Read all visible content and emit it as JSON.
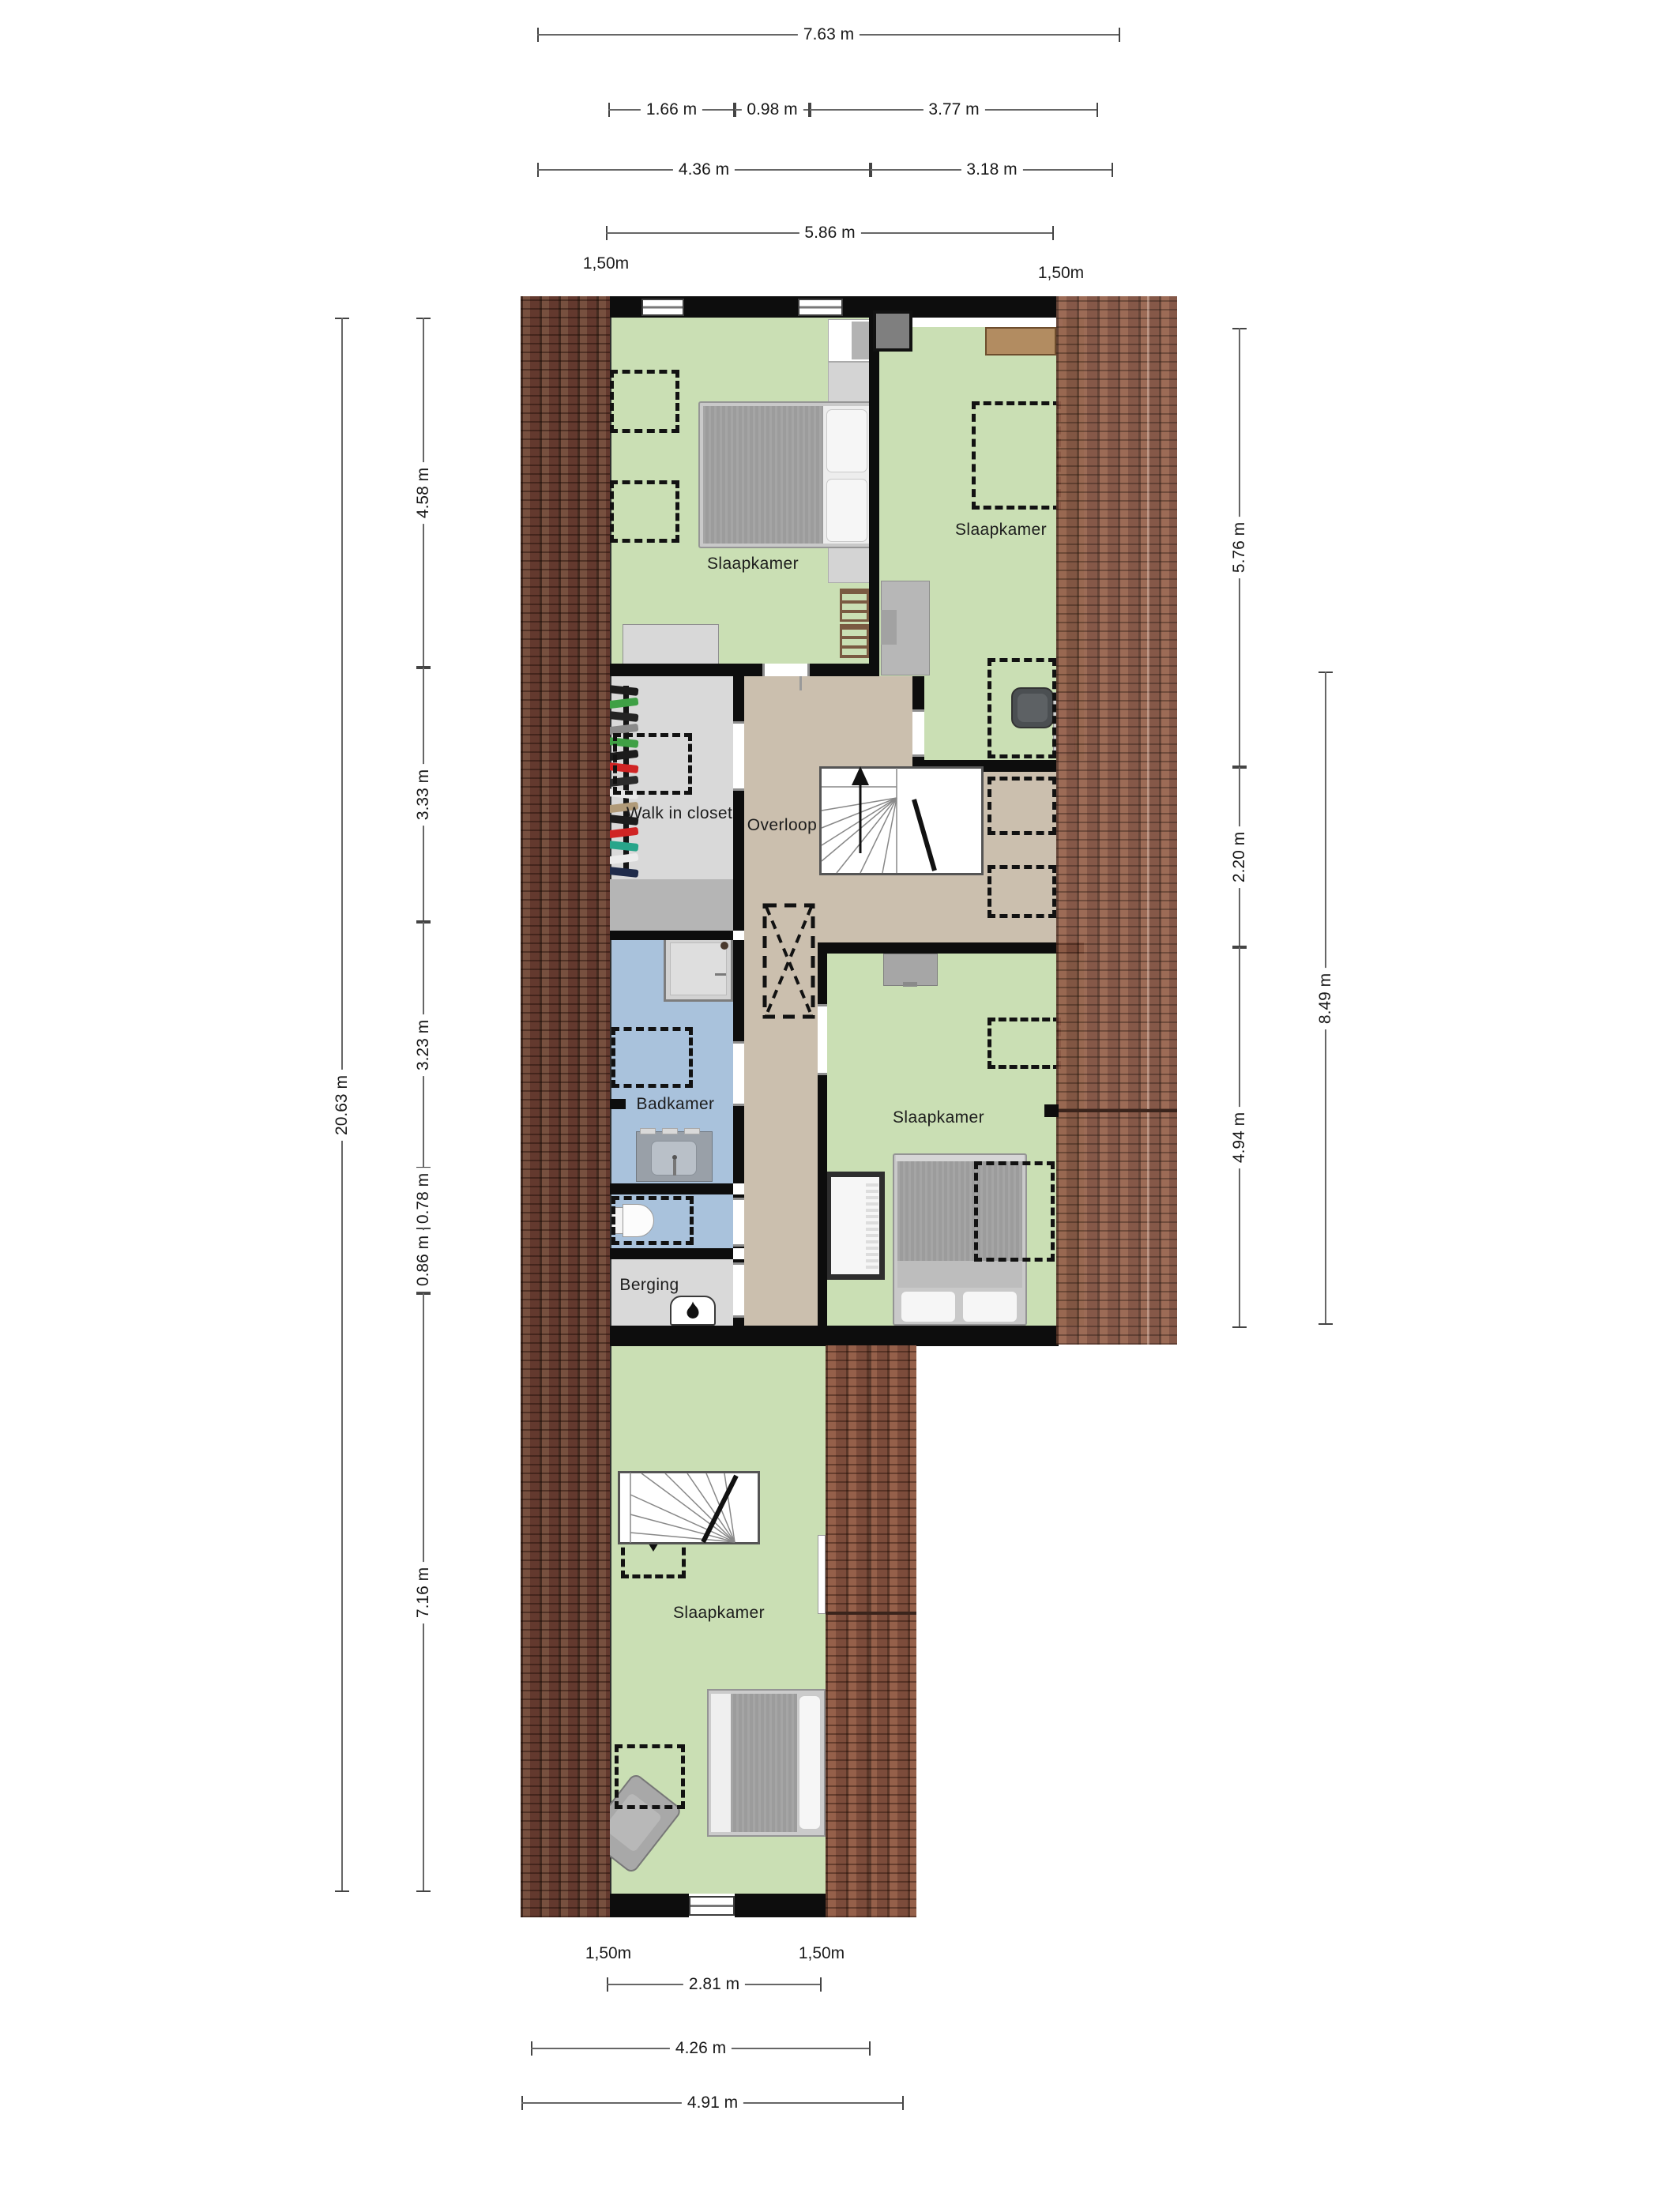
{
  "rooms": {
    "bedroom_nw": {
      "label": "Slaapkamer"
    },
    "bedroom_ne": {
      "label": "Slaapkamer"
    },
    "walk_in_closet": {
      "label": "Walk in closet"
    },
    "landing": {
      "label": "Overloop"
    },
    "bathroom": {
      "label": "Badkamer"
    },
    "bedroom_e": {
      "label": "Slaapkamer"
    },
    "storage": {
      "label": "Berging"
    },
    "bedroom_s": {
      "label": "Slaapkamer"
    }
  },
  "dimensions": {
    "top": [
      "7.63 m",
      "1.66 m",
      "0.98 m",
      "3.77 m",
      "4.36 m",
      "3.18 m",
      "5.86 m"
    ],
    "left_outer": "20.63 m",
    "left_inner": [
      "4.58 m",
      "3.33 m",
      "3.23 m",
      "0.78 m",
      "0.86 m",
      "7.16 m"
    ],
    "right_inner": [
      "5.76 m",
      "2.20 m",
      "4.94 m"
    ],
    "right_outer": "8.49 m",
    "bottom": [
      "2.81 m",
      "4.26 m",
      "4.91 m"
    ],
    "knee_wall_heights": [
      "1,50m",
      "1,50m",
      "1,50m",
      "1,50m"
    ]
  },
  "colors": {
    "room_green": "#cadfb4",
    "landing_tan": "#cbbfae",
    "bathroom_blue": "#a9c2dc",
    "closet_gray": "#d9d9d9",
    "closet_low_roof_gray": "#b5b5b5",
    "wall_black": "#0d0d0d",
    "roof_brick": "#8a5a45",
    "roof_brick_dark": "#6f463a"
  },
  "closet": {
    "clothes_colors": [
      "#1c1c1c",
      "#3fa045",
      "#232323",
      "#8a8a8a",
      "#3fa045",
      "#1c1c1c",
      "#d02424",
      "#2b2b2b",
      "#e8e8e8",
      "#b09a78",
      "#1c1c1c",
      "#d02424",
      "#28a58a",
      "#ececec",
      "#1f2b4a"
    ]
  }
}
